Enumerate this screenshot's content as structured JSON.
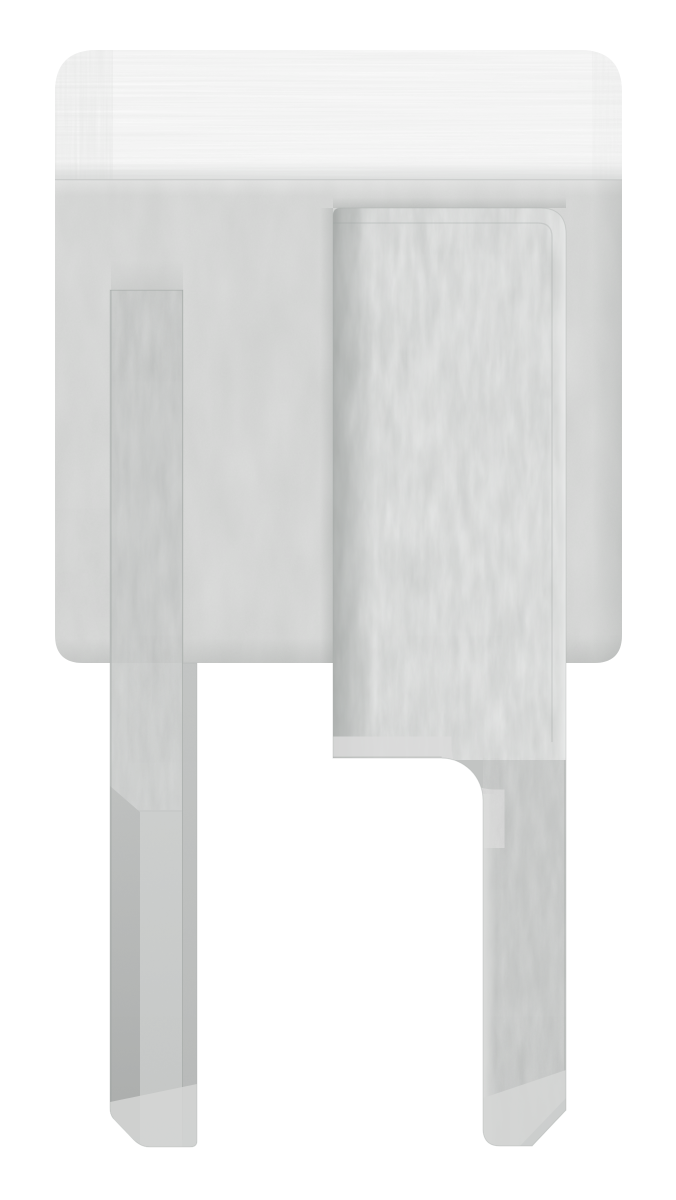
{
  "image": {
    "kind": "product-photo",
    "alt": "Brushed stainless steel adapter fitting: rectangular cap with a polished top band and two flat weld tabs pointing downward, photographed on a plain white background",
    "background": "#ffffff"
  },
  "palette": {
    "background": "#ffffff",
    "band_base": "#efefef",
    "face_base": "#d4d5d4",
    "tab_base": "#c9cbca",
    "panel_base": "#cacccb",
    "leg_base": "#c2c4c3",
    "chamfer_light": "#d5d6d5",
    "side_shade": "#b0b2b1"
  },
  "parts": {
    "cap_band": "brushed top band of cap",
    "cap_face": "matte front face of cap",
    "left_tab": "left flat tab",
    "right_panel": "right flat tab front panel",
    "right_leg": "right tab lower leg"
  }
}
